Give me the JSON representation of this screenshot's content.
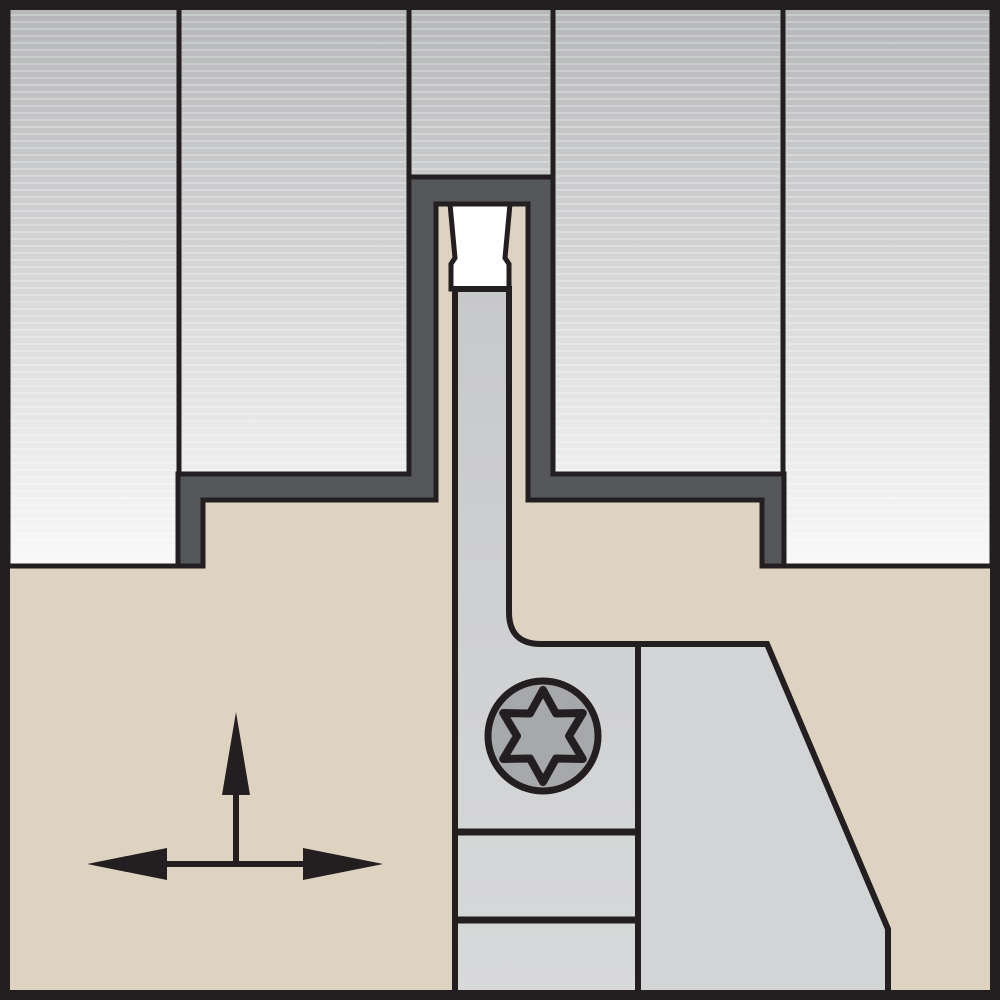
{
  "diagram": {
    "kind": "technical-cross-section",
    "subject": "grooving-tool-holder-in-workpiece-groove",
    "components": {
      "workpiece": "workpiece-cross-section",
      "groove_wall": "machined-groove-wall",
      "insert": "grooving-insert",
      "blade": "insert-support-blade",
      "holder_body": "tool-holder-body",
      "clamp_block": "clamp-block",
      "support_wedge": "support-wedge",
      "screw": "torx-clamp-screw",
      "arrows": "feed-direction-arrows"
    },
    "arrows": {
      "vertical_direction": "up",
      "horizontal_direction": "left-right"
    }
  },
  "colors": {
    "background": "#ffffff",
    "frame": "#231f20",
    "line": "#231f20",
    "workpiece_top": "#b5b6b8",
    "workpiece_bottom": "#fbfbfb",
    "stripe": "#ffffff",
    "groove_wall": "#56575a",
    "holder_body": "#ded3c1",
    "insert": "#ffffff",
    "blade_top": "#c7c8ca",
    "blade_bottom": "#d8d9da",
    "support": "#d3d4d6",
    "screw": "#a7a8ab",
    "arrow": "#231f20"
  }
}
